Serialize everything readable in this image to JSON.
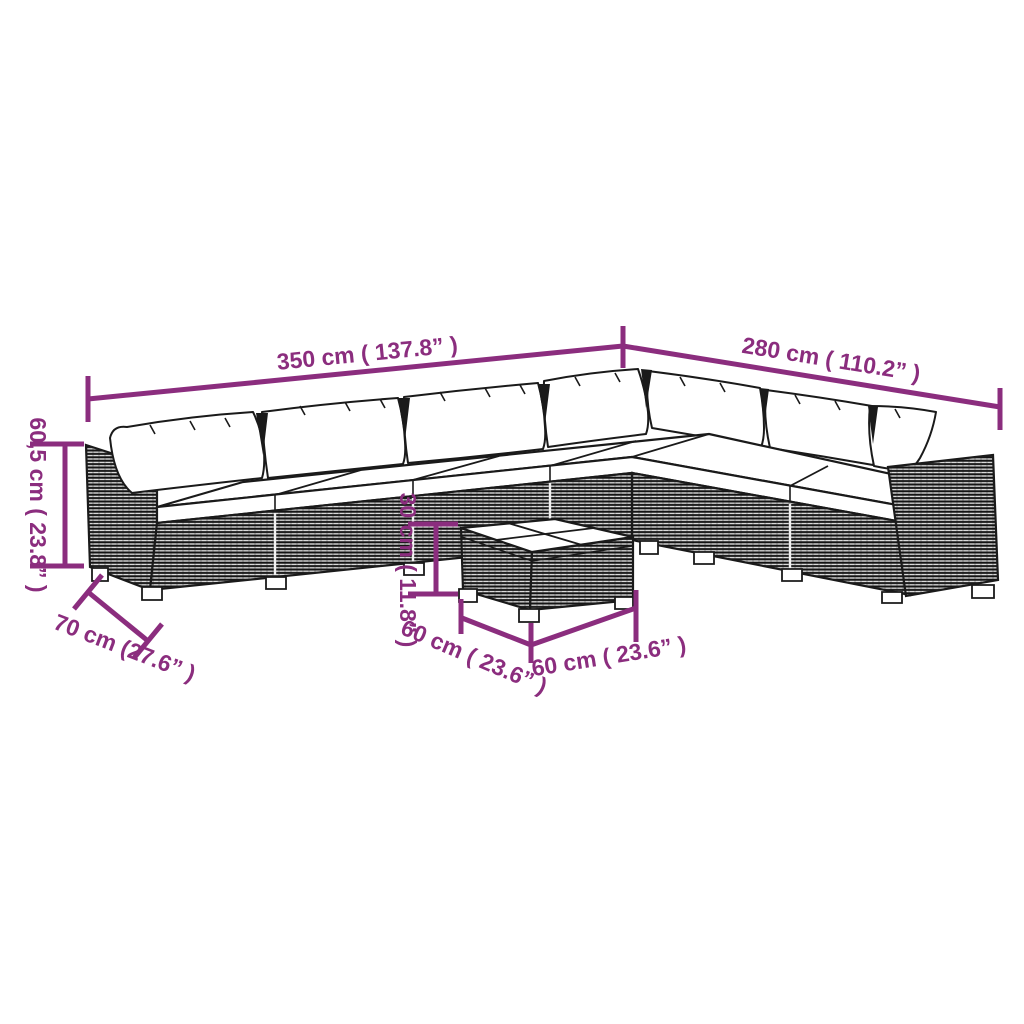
{
  "page": {
    "background": "#ffffff"
  },
  "colors": {
    "dimension_accent": "#8B2D7E",
    "sketch_line": "#1a1a1a",
    "cushion_fill": "#ffffff"
  },
  "diagram": {
    "subject": "L-shaped rattan garden lounge set with back pillows, seat cushions and square coffee table",
    "labels": {
      "length_left": "350 cm ( 137.8” )",
      "length_right": "280 cm ( 110.2” )",
      "sofa_height": "60,5 cm ( 23.8” )",
      "sofa_depth": "70 cm (27.6” )",
      "table_height": "30 cm ( 11.8” )",
      "table_width": "60 cm ( 23.6” )",
      "table_depth": "60 cm ( 23.6” )"
    }
  }
}
